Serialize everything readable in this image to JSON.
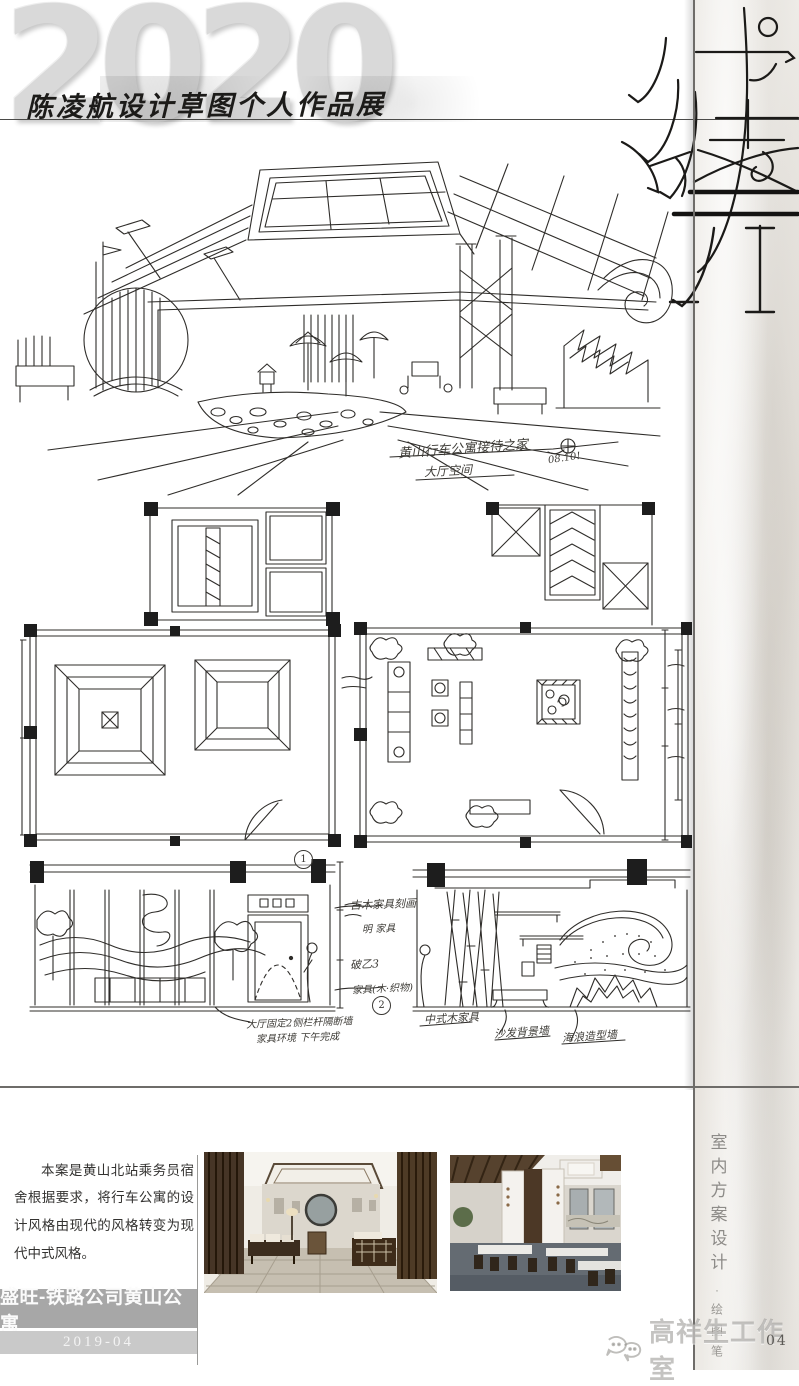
{
  "page": {
    "number": "04"
  },
  "header": {
    "year": "2020",
    "title": "陈凌航设计草图个人作品展"
  },
  "perspective": {
    "caption": "黄山行车公寓接待之家",
    "caption2": "大厅空间",
    "date": "08.10!"
  },
  "elevations": {
    "label_left": "1",
    "label_mid": "2",
    "mid_notes": [
      "古木家具刻画",
      "明 家具",
      "破乙3",
      "家具(木·织物)"
    ],
    "left_notes": [
      "大厅固定2侧栏杆隔断墙",
      "家具环境 下午完成"
    ],
    "right_notes": [
      "中式木家具",
      "沙发背景墙",
      "海浪造型墙"
    ]
  },
  "description": "本案是黄山北站乘务员宿舍根据要求，将行车公寓的设计风格由现代的风格转变为现代中式风格。",
  "footer": {
    "project": "盛旺-铁路公司黄山公寓",
    "date": "2019-04"
  },
  "side": {
    "vertical_title": "室内方案设计",
    "separator": "·",
    "pen_label": "绘图笔",
    "watermark": "高祥生工作室"
  }
}
